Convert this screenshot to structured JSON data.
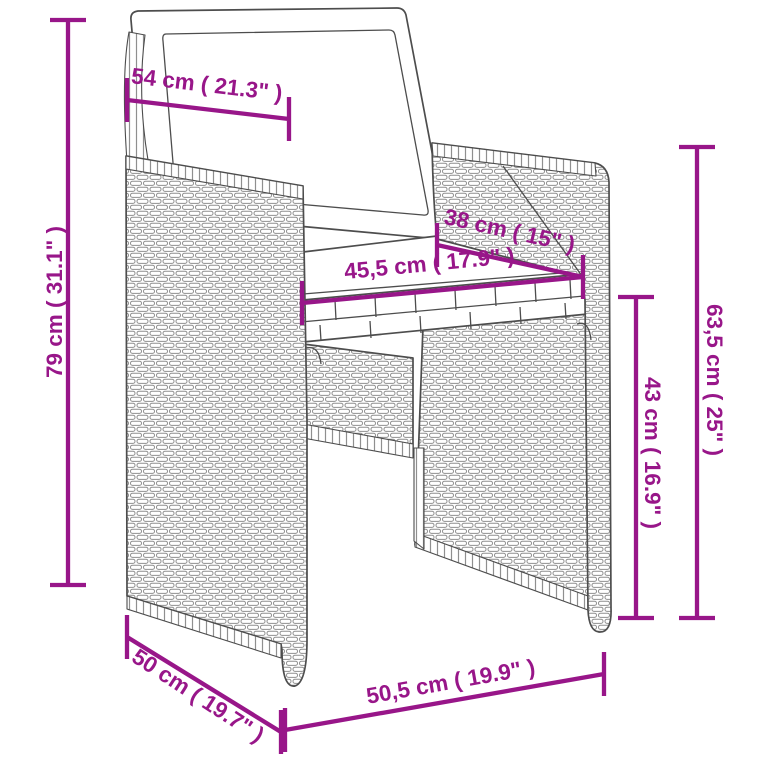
{
  "image": {
    "description": "Product dimension diagram of a poly rattan wicker dining chair with white back and seat cushions",
    "background": "#ffffff"
  },
  "colors": {
    "dimension": "#981689",
    "outline": "#4d4d4d",
    "weave": "#8f8f8f"
  },
  "dimensions": {
    "backrest_width": {
      "label": "54 cm ( 21.3\" )"
    },
    "total_height": {
      "label": "79 cm ( 31.1\" )"
    },
    "seat_depth": {
      "label": "38 cm ( 15\" )"
    },
    "seat_width": {
      "label": "45,5 cm ( 17.9\" )"
    },
    "armrest_height": {
      "label": "63,5 cm ( 25\" )"
    },
    "seat_height": {
      "label": "43 cm ( 16.9\" )"
    },
    "base_depth": {
      "label": "50 cm ( 19.7\" )"
    },
    "base_width": {
      "label": "50,5 cm ( 19.9\" )"
    }
  }
}
